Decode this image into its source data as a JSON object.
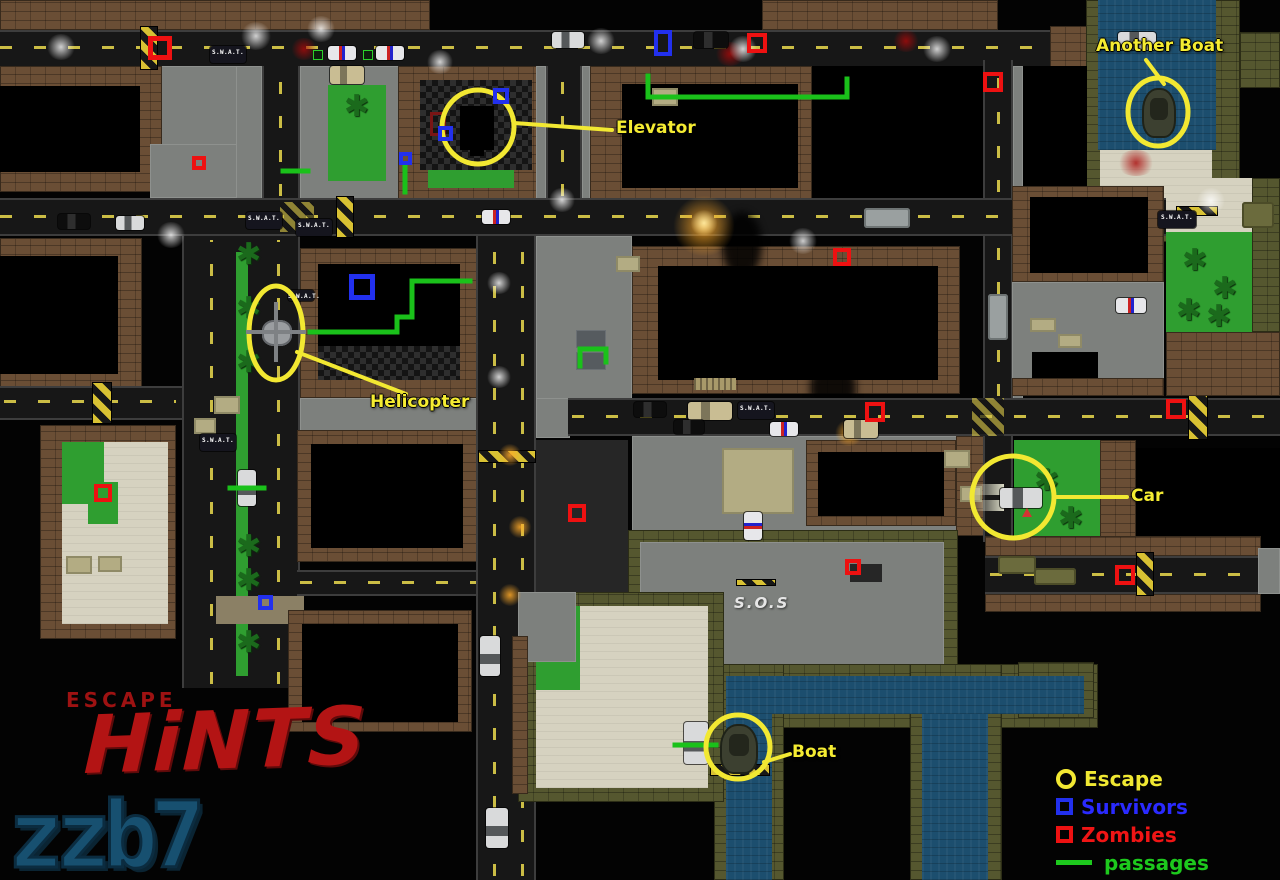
{
  "title": {
    "escape_label": "ESCAPE",
    "hints_label": "HiNTS",
    "watermark": "zzb7"
  },
  "map_text": {
    "sos": "S.O.S",
    "swat_van_label": "S.W.A.T."
  },
  "colors": {
    "annotation": "#f2e832",
    "zombie": "#ee1111",
    "survivor": "#2230ee",
    "passage": "#1ac11a",
    "title_red": "#b31414",
    "watermark_blue": "#175070"
  },
  "legend": {
    "items": [
      {
        "symbol": "circle",
        "color": "#f2e832",
        "label": "Escape",
        "label_color": "#f0e832"
      },
      {
        "symbol": "square",
        "color": "#2230ee",
        "label": "Survivors",
        "label_color": "#2a2aff"
      },
      {
        "symbol": "square",
        "color": "#ee1111",
        "label": "Zombies",
        "label_color": "#f01515"
      },
      {
        "symbol": "line",
        "color": "#1dc91d",
        "label": "passages",
        "label_color": "#1dc91d"
      }
    ]
  },
  "annotations": [
    {
      "id": "another-boat",
      "label": "Another Boat",
      "text": {
        "x": 1096,
        "y": 36
      },
      "circle": {
        "cx": 1158,
        "cy": 112,
        "rx": 30,
        "ry": 34
      },
      "line": [
        [
          1146,
          60
        ],
        [
          1164,
          84
        ]
      ]
    },
    {
      "id": "elevator",
      "label": "Elevator",
      "text": {
        "x": 616,
        "y": 118
      },
      "circle": {
        "cx": 478,
        "cy": 127,
        "rx": 36,
        "ry": 37
      },
      "line": [
        [
          514,
          123
        ],
        [
          612,
          130
        ]
      ]
    },
    {
      "id": "helicopter",
      "label": "Helicopter",
      "text": {
        "x": 370,
        "y": 392
      },
      "circle": {
        "cx": 276,
        "cy": 333,
        "rx": 27,
        "ry": 47
      },
      "line": [
        [
          297,
          352
        ],
        [
          406,
          394
        ]
      ]
    },
    {
      "id": "car",
      "label": "Car",
      "text": {
        "x": 1131,
        "y": 486
      },
      "circle": {
        "cx": 1013,
        "cy": 497,
        "rx": 41,
        "ry": 41
      },
      "line": [
        [
          1055,
          497
        ],
        [
          1127,
          497
        ]
      ]
    },
    {
      "id": "boat",
      "label": "Boat",
      "text": {
        "x": 792,
        "y": 742
      },
      "circle": {
        "cx": 738,
        "cy": 747,
        "rx": 32,
        "ry": 32
      },
      "line": [
        [
          764,
          762
        ],
        [
          790,
          754
        ]
      ]
    }
  ],
  "markers": {
    "zombies": [
      {
        "x": 160,
        "y": 48,
        "s": 24
      },
      {
        "x": 757,
        "y": 43,
        "s": 20
      },
      {
        "x": 993,
        "y": 82,
        "s": 20
      },
      {
        "x": 842,
        "y": 257,
        "s": 18
      },
      {
        "x": 875,
        "y": 412,
        "s": 20
      },
      {
        "x": 1176,
        "y": 409,
        "s": 20
      },
      {
        "x": 577,
        "y": 513,
        "s": 18
      },
      {
        "x": 853,
        "y": 567,
        "s": 16
      },
      {
        "x": 1125,
        "y": 575,
        "s": 20
      },
      {
        "x": 103,
        "y": 493,
        "s": 18
      },
      {
        "x": 199,
        "y": 163,
        "s": 14
      }
    ],
    "survivors": [
      {
        "x": 663,
        "y": 43,
        "s": 18,
        "h": 26
      },
      {
        "x": 362,
        "y": 287,
        "s": 26
      },
      {
        "x": 501,
        "y": 96,
        "s": 16
      },
      {
        "x": 445,
        "y": 133,
        "s": 15
      },
      {
        "x": 405,
        "y": 158,
        "s": 13
      },
      {
        "x": 265,
        "y": 602,
        "s": 15
      }
    ]
  },
  "passages": [
    [
      [
        648,
        76
      ],
      [
        648,
        97
      ],
      [
        847,
        97
      ],
      [
        847,
        79
      ]
    ],
    [
      [
        310,
        332
      ],
      [
        397,
        332
      ],
      [
        397,
        317
      ],
      [
        412,
        317
      ],
      [
        412,
        281
      ],
      [
        470,
        281
      ]
    ],
    [
      [
        580,
        366
      ],
      [
        580,
        349
      ],
      [
        606,
        349
      ],
      [
        606,
        362
      ]
    ],
    [
      [
        283,
        171
      ],
      [
        308,
        171
      ]
    ],
    [
      [
        405,
        165
      ],
      [
        405,
        192
      ]
    ],
    [
      [
        230,
        488
      ],
      [
        264,
        488
      ]
    ],
    [
      [
        675,
        745
      ],
      [
        716,
        745
      ]
    ]
  ]
}
